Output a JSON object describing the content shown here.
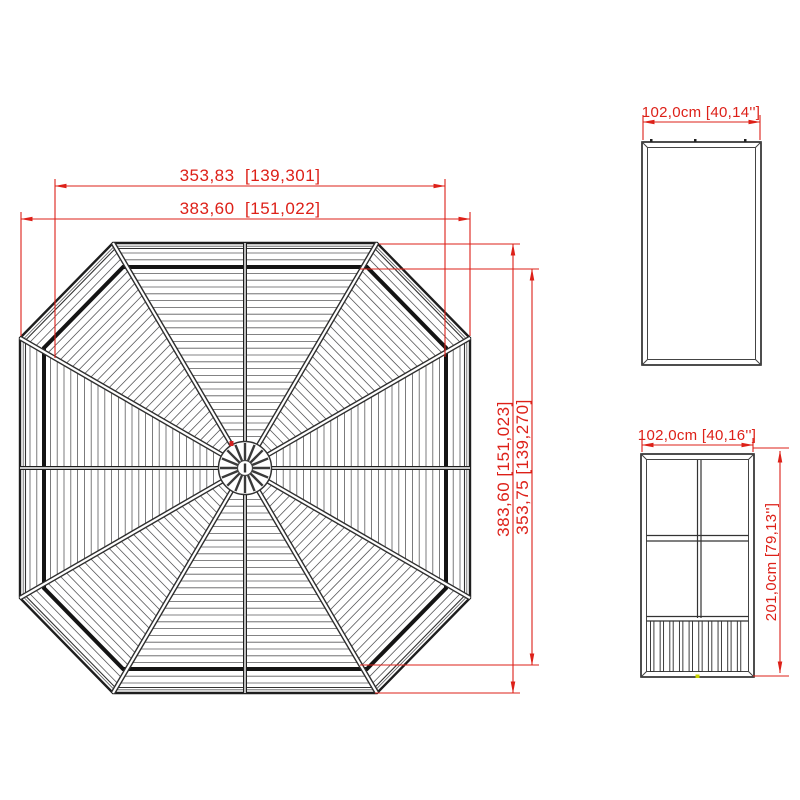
{
  "drawing": {
    "type": "technical-drawing",
    "subject": "octagonal gazebo roof plan with roof panel and wall panel side views",
    "colors": {
      "dimension_red": "#dd2018",
      "line_dark": "#1e1e1e",
      "line_medium": "#333333",
      "slat_gray": "#5a5a5c",
      "purlin_black": "#141414",
      "marker_red_dot": "#d42020",
      "marker_yellow_dot": "#c9d300",
      "background": "#ffffff"
    },
    "roof_plan": {
      "width_top": "353,83  [139,301]",
      "width_overall": "383,60  [151,022]",
      "height_overall": "383,60 [151,023]",
      "height_inner": "353,75 [139,270]"
    },
    "roof_panel": {
      "width": "102,0cm [40,14'']"
    },
    "wall_panel": {
      "width": "102,0cm [40,16'']",
      "height": "201,0cm [79,13'']"
    }
  }
}
